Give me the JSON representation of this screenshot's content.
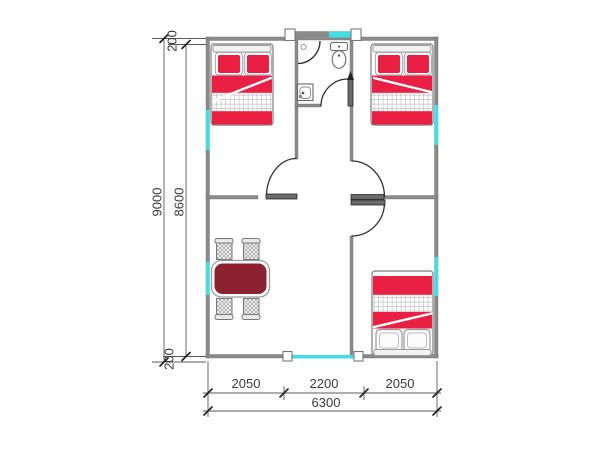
{
  "diagram": {
    "type": "architectural-floor-plan",
    "rooms": [
      "bedroom-top-left",
      "bathroom",
      "bedroom-top-right",
      "living-dining-hall",
      "bedroom-bottom-right"
    ],
    "fixtures": [
      "double-bed",
      "double-bed",
      "double-bed",
      "dining-table",
      "chair",
      "chair",
      "chair",
      "chair",
      "toilet",
      "wash-basin",
      "shower",
      "swing-door",
      "window"
    ]
  },
  "colors": {
    "bed_red": "#ea1f44",
    "table_maroon": "#8c2130",
    "window_cyan": "#40dfe6",
    "wall_gray": "#8a8a8a",
    "line_dark": "#2f2f2f"
  },
  "dimensions": {
    "left": {
      "total": "9000",
      "inner": "8600",
      "top_offset": "200",
      "bottom_offset": "200"
    },
    "bottom": {
      "segments": [
        "2050",
        "2200",
        "2050"
      ],
      "total": "6300"
    }
  }
}
